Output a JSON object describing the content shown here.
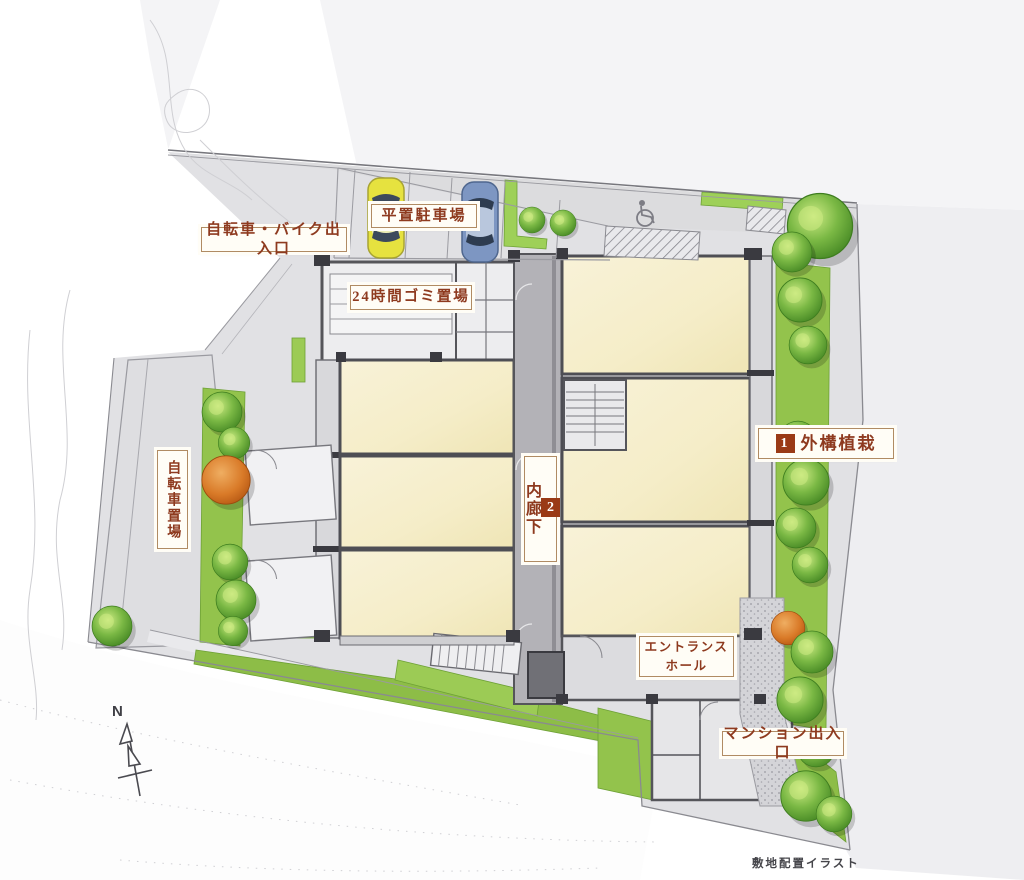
{
  "title": "敷地配置イラスト",
  "labels": {
    "bike_entrance": "自転車・バイク出入口",
    "flat_parking": "平置駐車場",
    "garbage_24h": "24時間ゴミ置場",
    "bicycle_parking": "自転車置場",
    "inner_corridor_num": "2",
    "inner_corridor": "内廊下",
    "exterior_planting_num": "1",
    "exterior_planting": "外構植栽",
    "entrance_hall_l1": "エントランス",
    "entrance_hall_l2": "ホール",
    "mansion_entrance": "マンション出入口",
    "caption": "敷地配置イラスト",
    "compass_north": "N"
  },
  "palette": {
    "label-text": "#8e3a1f",
    "label-border": "#b08b63",
    "badge": "#9a3a16",
    "room": "#f6efcd",
    "wall": "#4e4e54",
    "corridor": "#b3b2b7",
    "site": "#e1e1e4",
    "green": "#93c34c",
    "tree2": "#4d9426",
    "treeO2": "#c05f14",
    "car-yellow": "#e6e23f",
    "car-blue": "#7d96c2"
  }
}
